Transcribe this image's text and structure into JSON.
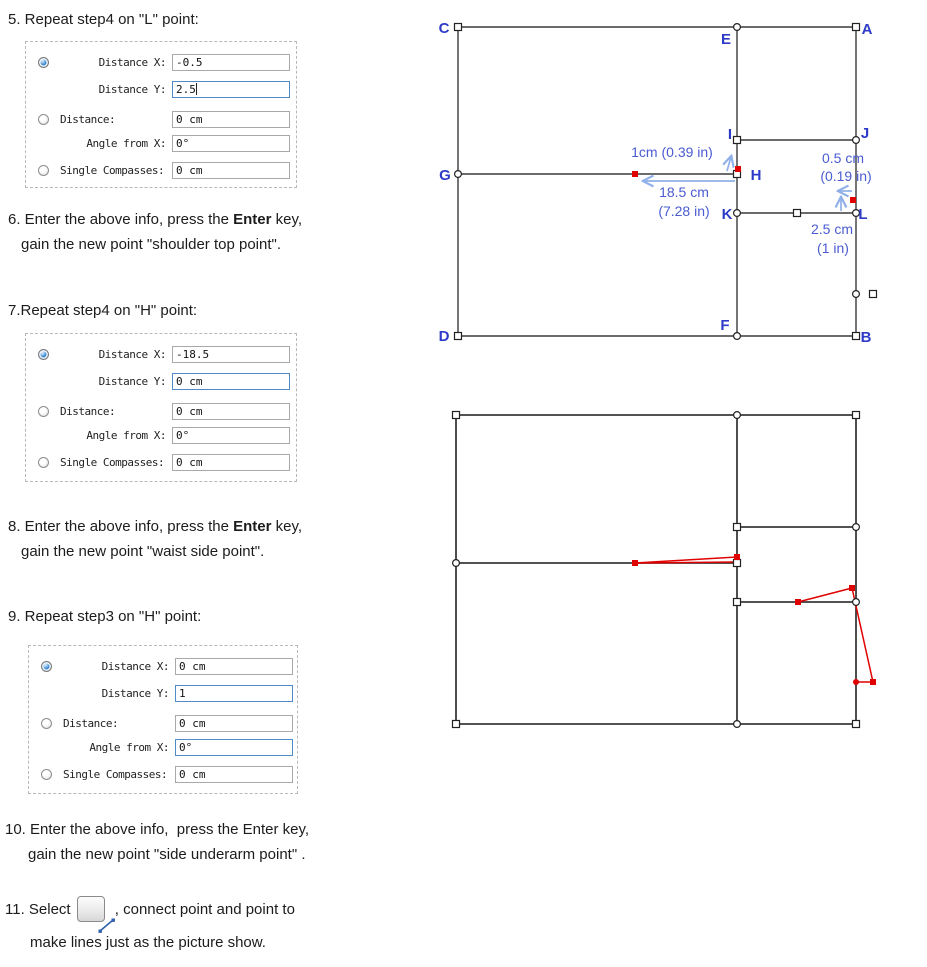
{
  "colors": {
    "label_blue": "#2e3bc8",
    "annotation_blue": "#4a5cd0",
    "arrow_blue": "#8fb0e8",
    "red": "#e00000",
    "line": "#3a3a3a",
    "focus_border": "#4f8ac9"
  },
  "steps": {
    "s5": "5. Repeat step4 on \"L\" point:",
    "s6_pre": "6. Enter the above info, press the ",
    "s6_bold": "Enter",
    "s6_post": " key,",
    "s6_l2": "gain the new point \"shoulder top point\".",
    "s7": "7.Repeat step4 on \"H\" point:",
    "s8_pre": "8. Enter the above info, press the ",
    "s8_bold": "Enter",
    "s8_post": " key,",
    "s8_l2": "gain the new point \"waist side point\".",
    "s9": "9. Repeat step3 on \"H\" point:",
    "s10_l1": "10. Enter the above info,  press the Enter key,",
    "s10_l2": "gain the new point \"side underarm point\" .",
    "s11_pre": "11. Select",
    "s11_post": " , connect point and point to",
    "s11_l2": "make lines just as the picture show.",
    "s11_icon": "line-tool"
  },
  "panels": [
    {
      "rows": [
        {
          "radio": "selected",
          "label": "Distance X:",
          "align": "r",
          "value": "-0.5",
          "focused": false,
          "cursor": false
        },
        {
          "radio": null,
          "label": "Distance Y:",
          "align": "r",
          "value": "2.5",
          "focused": true,
          "cursor": true
        },
        {
          "radio": "unselected",
          "label": "Distance:",
          "align": "l",
          "value": "0 cm",
          "focused": false,
          "cursor": false
        },
        {
          "radio": null,
          "label": "Angle from X:",
          "align": "r",
          "value": "0°",
          "focused": false,
          "cursor": false
        },
        {
          "radio": "unselected",
          "label": "Single Compasses:",
          "align": "l",
          "value": "0 cm",
          "focused": false,
          "cursor": false
        }
      ]
    },
    {
      "rows": [
        {
          "radio": "selected",
          "label": "Distance X:",
          "align": "r",
          "value": "-18.5",
          "focused": false,
          "cursor": false
        },
        {
          "radio": null,
          "label": "Distance Y:",
          "align": "r",
          "value": "0 cm",
          "focused": true,
          "cursor": false
        },
        {
          "radio": "unselected",
          "label": "Distance:",
          "align": "l",
          "value": "0 cm",
          "focused": false,
          "cursor": false
        },
        {
          "radio": null,
          "label": "Angle from X:",
          "align": "r",
          "value": "0°",
          "focused": false,
          "cursor": false
        },
        {
          "radio": "unselected",
          "label": "Single Compasses:",
          "align": "l",
          "value": "0 cm",
          "focused": false,
          "cursor": false
        }
      ]
    },
    {
      "rows": [
        {
          "radio": "selected",
          "label": "Distance X:",
          "align": "r",
          "value": "0 cm",
          "focused": false,
          "cursor": false
        },
        {
          "radio": null,
          "label": "Distance Y:",
          "align": "r",
          "value": "1",
          "focused": true,
          "cursor": false
        },
        {
          "radio": "unselected",
          "label": "Distance:",
          "align": "l",
          "value": "0 cm",
          "focused": false,
          "cursor": false
        },
        {
          "radio": null,
          "label": "Angle from X:",
          "align": "r",
          "value": "0°",
          "focused": true,
          "cursor": false
        },
        {
          "radio": "unselected",
          "label": "Single Compasses:",
          "align": "l",
          "value": "0 cm",
          "focused": false,
          "cursor": false
        }
      ]
    }
  ],
  "diagrams": [
    {
      "name": "annotated-pattern",
      "stroke_w": 1.4,
      "lines": [
        [
          458,
          27,
          856,
          27
        ],
        [
          458,
          27,
          458,
          336
        ],
        [
          458,
          336,
          856,
          336
        ],
        [
          856,
          27,
          856,
          336
        ],
        [
          737,
          27,
          737,
          336
        ],
        [
          458,
          174,
          737,
          174
        ],
        [
          737,
          140,
          856,
          140
        ],
        [
          737,
          213,
          856,
          213
        ]
      ],
      "red_lines": [],
      "arrows": [
        [
          735,
          181,
          644,
          181
        ],
        [
          727,
          171,
          731,
          157
        ],
        [
          852,
          191,
          839,
          191
        ],
        [
          841,
          211,
          841,
          198
        ]
      ],
      "markers": [
        {
          "x": 458,
          "y": 27,
          "shape": "sq",
          "fill": "w"
        },
        {
          "x": 856,
          "y": 27,
          "shape": "sq",
          "fill": "w"
        },
        {
          "x": 458,
          "y": 336,
          "shape": "sq",
          "fill": "w"
        },
        {
          "x": 856,
          "y": 336,
          "shape": "sq",
          "fill": "w"
        },
        {
          "x": 737,
          "y": 27,
          "shape": "ci",
          "fill": "w"
        },
        {
          "x": 458,
          "y": 174,
          "shape": "ci",
          "fill": "w"
        },
        {
          "x": 737,
          "y": 336,
          "shape": "ci",
          "fill": "w"
        },
        {
          "x": 737,
          "y": 140,
          "shape": "sq",
          "fill": "w"
        },
        {
          "x": 856,
          "y": 140,
          "shape": "ci",
          "fill": "w"
        },
        {
          "x": 737,
          "y": 174,
          "shape": "sq",
          "fill": "w"
        },
        {
          "x": 737,
          "y": 213,
          "shape": "ci",
          "fill": "w"
        },
        {
          "x": 856,
          "y": 213,
          "shape": "ci",
          "fill": "w"
        },
        {
          "x": 797,
          "y": 213,
          "shape": "sq",
          "fill": "w"
        },
        {
          "x": 856,
          "y": 294,
          "shape": "ci",
          "fill": "w"
        },
        {
          "x": 873,
          "y": 294,
          "shape": "sq",
          "fill": "w"
        },
        {
          "x": 635,
          "y": 174,
          "shape": "sq",
          "fill": "r"
        },
        {
          "x": 738,
          "y": 169,
          "shape": "sq",
          "fill": "r"
        },
        {
          "x": 853,
          "y": 200,
          "shape": "sq",
          "fill": "r"
        }
      ],
      "annotations": [
        {
          "t": "1cm (0.39 in)",
          "x": 672,
          "y": 157
        },
        {
          "t": "18.5 cm",
          "x": 684,
          "y": 197
        },
        {
          "t": "(7.28 in)",
          "x": 684,
          "y": 216
        },
        {
          "t": "0.5 cm",
          "x": 843,
          "y": 163
        },
        {
          "t": "(0.19 in)",
          "x": 846,
          "y": 181
        },
        {
          "t": "2.5 cm",
          "x": 832,
          "y": 234
        },
        {
          "t": "(1 in)",
          "x": 833,
          "y": 253
        }
      ],
      "labels": [
        {
          "t": "C",
          "x": 444,
          "y": 33
        },
        {
          "t": "A",
          "x": 867,
          "y": 34
        },
        {
          "t": "E",
          "x": 726,
          "y": 44
        },
        {
          "t": "G",
          "x": 445,
          "y": 180
        },
        {
          "t": "H",
          "x": 756,
          "y": 180
        },
        {
          "t": "I",
          "x": 730,
          "y": 139
        },
        {
          "t": "J",
          "x": 865,
          "y": 138
        },
        {
          "t": "K",
          "x": 727,
          "y": 219
        },
        {
          "t": "L",
          "x": 863,
          "y": 219
        },
        {
          "t": "D",
          "x": 444,
          "y": 341
        },
        {
          "t": "F",
          "x": 725,
          "y": 330
        },
        {
          "t": "B",
          "x": 866,
          "y": 342
        }
      ]
    },
    {
      "name": "connected-pattern",
      "stroke_w": 1.8,
      "lines": [
        [
          456,
          415,
          856,
          415
        ],
        [
          456,
          415,
          456,
          724
        ],
        [
          456,
          724,
          856,
          724
        ],
        [
          856,
          415,
          856,
          724
        ],
        [
          737,
          415,
          737,
          724
        ],
        [
          456,
          563,
          737,
          563
        ],
        [
          737,
          527,
          856,
          527
        ],
        [
          737,
          602,
          856,
          602
        ]
      ],
      "red_lines": [
        [
          635,
          563,
          737,
          557
        ],
        [
          635,
          563,
          737,
          562
        ],
        [
          798,
          602,
          852,
          588
        ],
        [
          852,
          588,
          873,
          682
        ],
        [
          856,
          682,
          873,
          682
        ]
      ],
      "arrows": [],
      "markers": [
        {
          "x": 456,
          "y": 415,
          "shape": "sq",
          "fill": "w"
        },
        {
          "x": 856,
          "y": 415,
          "shape": "sq",
          "fill": "w"
        },
        {
          "x": 456,
          "y": 724,
          "shape": "sq",
          "fill": "w"
        },
        {
          "x": 856,
          "y": 724,
          "shape": "sq",
          "fill": "w"
        },
        {
          "x": 737,
          "y": 415,
          "shape": "ci",
          "fill": "w"
        },
        {
          "x": 737,
          "y": 724,
          "shape": "ci",
          "fill": "w"
        },
        {
          "x": 456,
          "y": 563,
          "shape": "ci",
          "fill": "w"
        },
        {
          "x": 737,
          "y": 563,
          "shape": "sq",
          "fill": "w"
        },
        {
          "x": 737,
          "y": 527,
          "shape": "sq",
          "fill": "w"
        },
        {
          "x": 856,
          "y": 527,
          "shape": "ci",
          "fill": "w"
        },
        {
          "x": 737,
          "y": 602,
          "shape": "sq",
          "fill": "w"
        },
        {
          "x": 856,
          "y": 602,
          "shape": "ci",
          "fill": "w"
        },
        {
          "x": 635,
          "y": 563,
          "shape": "sq",
          "fill": "r"
        },
        {
          "x": 737,
          "y": 557,
          "shape": "sq",
          "fill": "r"
        },
        {
          "x": 798,
          "y": 602,
          "shape": "sq",
          "fill": "r"
        },
        {
          "x": 852,
          "y": 588,
          "shape": "sq",
          "fill": "r"
        },
        {
          "x": 873,
          "y": 682,
          "shape": "sq",
          "fill": "r"
        },
        {
          "x": 856,
          "y": 682,
          "shape": "ci",
          "fill": "r"
        }
      ],
      "annotations": [],
      "labels": []
    }
  ]
}
